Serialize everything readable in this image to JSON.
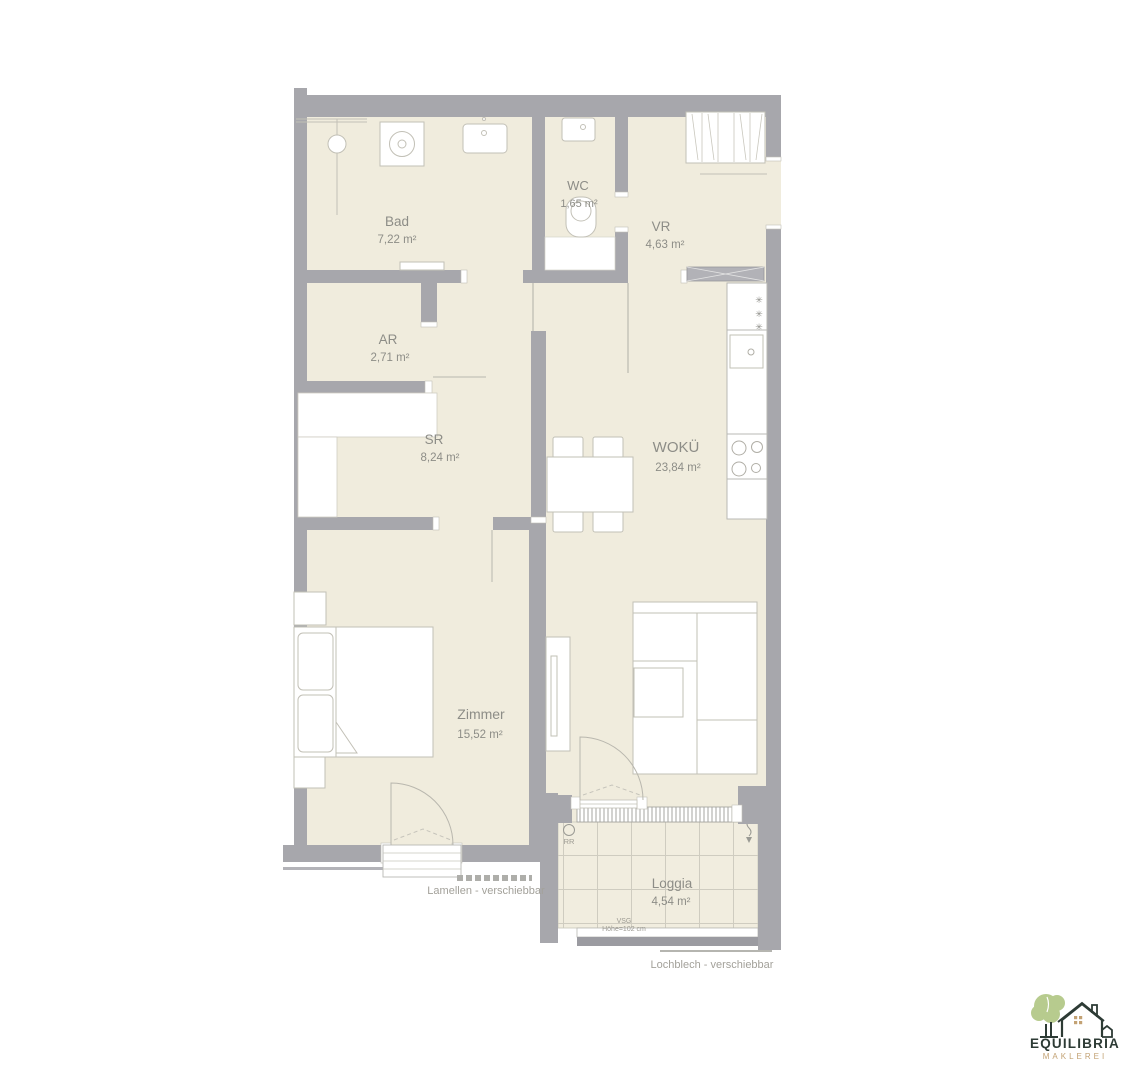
{
  "page": {
    "background": "#ffffff"
  },
  "floor_plan": {
    "rooms": [
      {
        "key": "bad",
        "name": "Bad",
        "area": "7,22 m²"
      },
      {
        "key": "wc",
        "name": "WC",
        "area": "1,65 m²"
      },
      {
        "key": "vr",
        "name": "VR",
        "area": "4,63 m²"
      },
      {
        "key": "ar",
        "name": "AR",
        "area": "2,71 m²"
      },
      {
        "key": "sr",
        "name": "SR",
        "area": "8,24 m²"
      },
      {
        "key": "woku",
        "name": "WOKÜ",
        "area": "23,84 m²"
      },
      {
        "key": "zimmer",
        "name": "Zimmer",
        "area": "15,52 m²"
      },
      {
        "key": "loggia",
        "name": "Loggia",
        "area": "4,54 m²"
      }
    ],
    "annotations": {
      "lamellen": "Lamellen - verschiebbar",
      "lochblech": "Lochblech - verschiebbar",
      "vsg_line1": "VSG",
      "vsg_line2": "Höhe=102 cm",
      "rr": "RR",
      "freezer_star": "✳"
    },
    "colors": {
      "floor": "#f0ecdd",
      "wall": "#a7a7ac",
      "furniture_stroke": "#c2c0b6",
      "label_text": "#8d8d87",
      "annotation_text": "#a3a19a"
    }
  },
  "logo": {
    "title": "EQUILIBRIA",
    "subtitle": "MAKLEREI",
    "colors": {
      "tree": "#b7cb8e",
      "outline": "#2d3b35",
      "subtitle": "#c3a274"
    }
  }
}
